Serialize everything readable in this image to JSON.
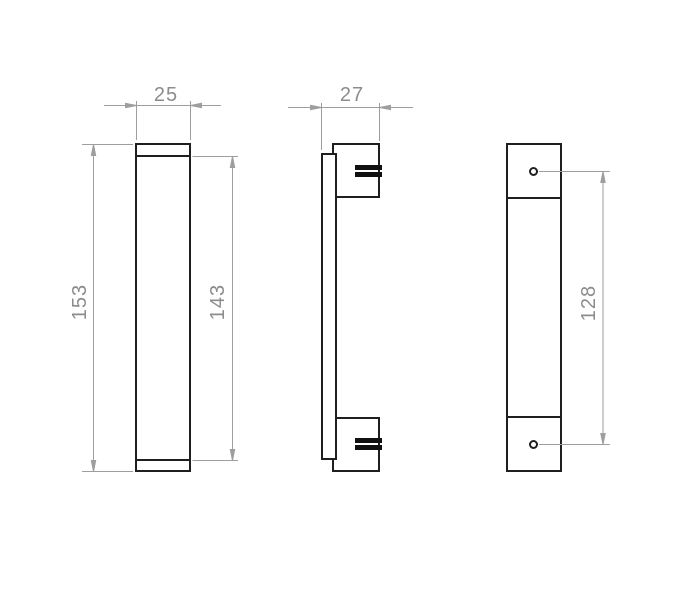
{
  "dimensions": {
    "front_width": "25",
    "side_depth": "27",
    "overall_height": "153",
    "grip_height": "143",
    "hole_spacing": "128"
  },
  "colors": {
    "background": "#ffffff",
    "part_outline": "#1f1f1f",
    "dimension_line": "#9e9e9e",
    "dimension_text": "#8c8c8c"
  }
}
